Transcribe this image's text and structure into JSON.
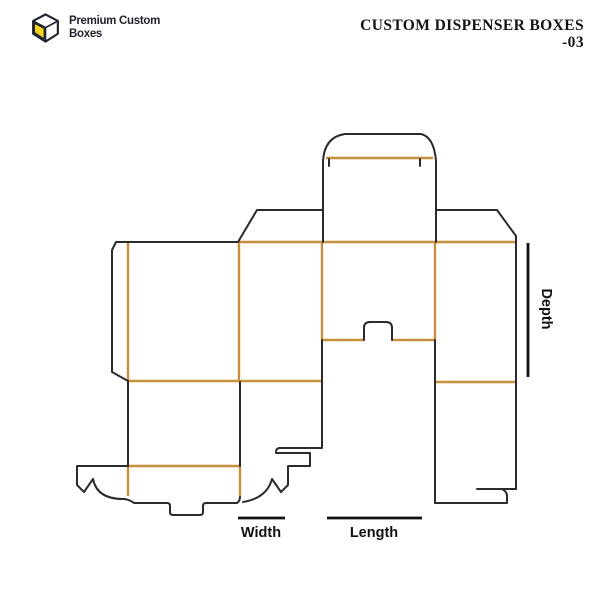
{
  "header": {
    "logo": {
      "icon": "box-cube-icon",
      "line1": "Premium Custom",
      "line2": "Boxes"
    },
    "title_line1": "CUSTOM DISPENSER BOXES",
    "title_line2": "-03"
  },
  "diagram": {
    "name": "custom-dispenser-box-dieline",
    "description": "Die-cut template (dieline) of a dispenser box with cut lines and crease lines",
    "dimension_labels": {
      "width": "Width",
      "length": "Length",
      "depth": "Depth"
    }
  },
  "colors": {
    "cut_line": "#2b2b2b",
    "crease_line": "#c6903c",
    "dim_line": "#111111",
    "logo_accent": "#f6d320",
    "logo_text": "#20242e",
    "title_text": "#141414",
    "background": "#ffffff"
  }
}
